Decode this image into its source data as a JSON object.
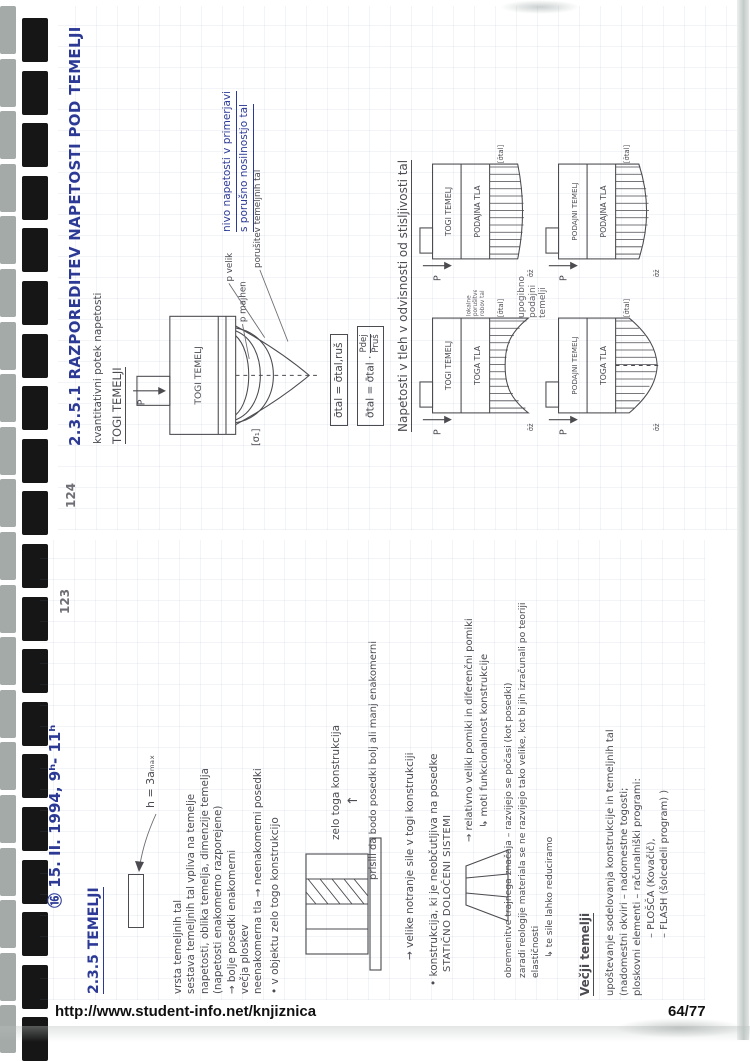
{
  "footer": {
    "url": "http://www.student-info.net/knjiznica",
    "page": "64/77"
  },
  "binding": {
    "count": 20
  },
  "colors": {
    "ink": "#2c3a96",
    "pencil": "#4b4b52"
  },
  "p124": {
    "number": "124",
    "title": "2.3.5.1  RAZPOREDITEV NAPETOSTI POD TEMELJI",
    "subtitle": "kvantitativni potek napetosti",
    "heading": "TOGI TEMELJI",
    "d1": {
      "p": "P",
      "block": "TOGI TEMELJ",
      "sigma": "[σ₁]",
      "small": "p majhen",
      "large": "p velik",
      "failure": "porušitev temeljnih tal",
      "note1": "nivo napetosti v primerjavi",
      "note2": "s porušno nosilnostjo tal"
    },
    "f1": "σ̄tal = σ̄tal,ruš",
    "f2": {
      "lhs": "σ̄tal = σ̄tal ·",
      "num": "Pdej",
      "den": "Pruš"
    },
    "heading2": "Napetosti v tleh v odvisnosti od stisljivosti tal",
    "between_note": [
      "upogibno",
      "podajni",
      "temelji"
    ],
    "grid": [
      {
        "p": "P",
        "found": "TOGI TEMELJ",
        "soil": "TOGA TLA",
        "sigma": "[σ̄tal]",
        "z": "σ̄z̄",
        "note1": "lokalne",
        "note2": "porušitve",
        "note3": "robov tal"
      },
      {
        "p": "P",
        "found": "TOGI TEMELJ",
        "soil": "PODAJNA TLA",
        "sigma": "[σ̄tal]",
        "z": "σ̄z̄"
      },
      {
        "p": "P",
        "found": "PODAJNI TEMELJ",
        "soil": "TOGA TLA",
        "sigma": "[σ̄tal]",
        "z": "σ̄z̄"
      },
      {
        "p": "P",
        "found": "PODAJNI TEMELJ",
        "soil": "PODAJNA TLA",
        "sigma": "[σ̄tal]",
        "z": "σ̄z̄"
      }
    ]
  },
  "p123": {
    "number": "123",
    "date": "⑯  15. II. 1994,  9ʰ- 11ʰ",
    "heading": "2.3.5  TEMELJI",
    "h_note": "h = 3aₘₐₓ",
    "para1": [
      "vrsta temeljnih tal",
      "sestava temeljnih tal vpliva na temelje",
      "napetosti, oblika temelja, dimenzije temelja",
      "(napetosti enakomerno razporejene)",
      "→ bolje  posedki enakomerni",
      "večja ploskev",
      "neenakomerna tla → neenakomerni posedki"
    ],
    "bullet1": "• v objektu zelo togo konstrukcijo",
    "stiff_label": "zelo toga konstrukcija",
    "arrow_up": "↑",
    "prisili": "prisili da bodo posedki bolj ali manj enakomerni",
    "velike": "→ velike notranje sile v togi konstrukciji",
    "bullet2": "• konstrukcija, ki je neobčutljiva na posedke",
    "bullet2b": "STATIČNO DOLOČENI SISTEMI",
    "pomiki1": "→ relativno veliki pomiki in diferenčni pomiki",
    "pomiki2": "↳ moti funkcionalnost konstrukcije",
    "obrem": [
      "obremenitve trajnega značaja – razvijejo se počasi (kot posedki)",
      "zaradi reologije materiala se ne razvijejo tako velike, kot bi jih izračunali po teoriji",
      "elastičnosti",
      "↳ te sile lahko reduciramo"
    ],
    "vecji": "Večji temelji",
    "upost": [
      "upoštevanje sodelovanja konstrukcije in temeljnih tal",
      "(nadomestni okviri – nadomestne togosti;",
      "ploskovni elementi – računalniški programi:",
      "–  PLOŠČA (Kovačič),",
      "–  FLASH (šolcedeli program)  )"
    ]
  }
}
